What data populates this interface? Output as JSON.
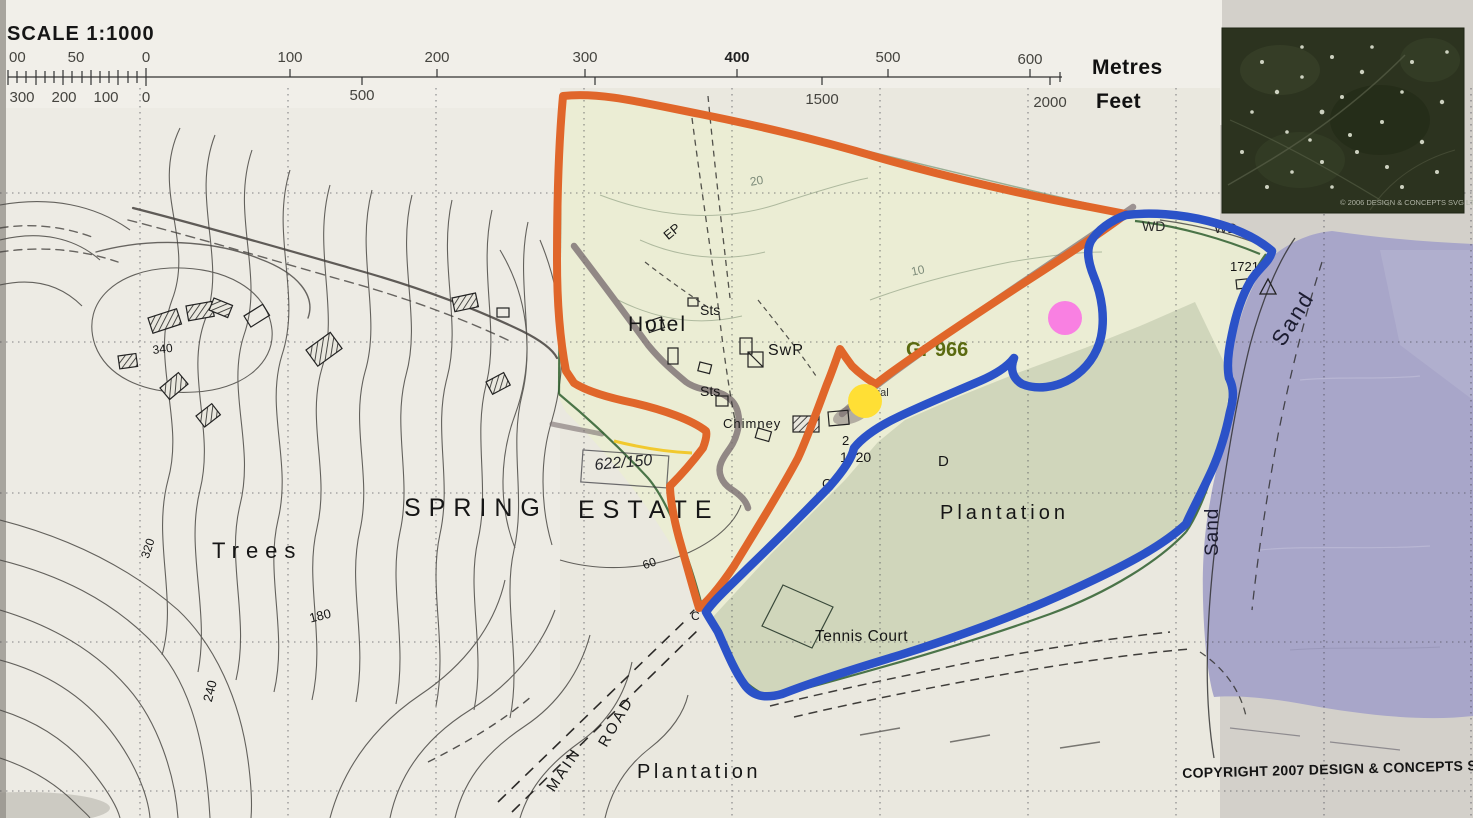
{
  "colors": {
    "orange-route": "#e0662a",
    "blue-route": "#2b52c8",
    "yellow-marker": "#ffdf35",
    "pink-marker": "#f980e2",
    "sea-lavender": "#a8a6c9",
    "estate-fill": "#eaedd2",
    "plantation-fill": "#cbd1b6",
    "road-gray": "#7a6e70",
    "boundary-green": "#2f5f2f",
    "grid-ink": "#3c3c44",
    "contour-ink": "#4b4945",
    "gr-text": "#5a6a10"
  },
  "scale": {
    "title": "SCALE 1:1000",
    "metres_unit": "Metres",
    "feet_unit": "Feet",
    "metres_ticks": [
      "00",
      "50",
      "0",
      "100",
      "200",
      "300",
      "400",
      "500",
      "600"
    ],
    "feet_ticks": [
      "300",
      "200",
      "100",
      "0",
      "500",
      "1500",
      "2000"
    ]
  },
  "labels": {
    "hotel": "Hotel",
    "sts_upper": "Sts",
    "swp": "SwP",
    "sts_lower": "Sts",
    "chimney": "Chimney",
    "ep": "EP",
    "trees": "Trees",
    "spring": "SPRING",
    "estate": "ESTATE",
    "plantation_mid": "Plantation",
    "plantation_bottom": "Plantation",
    "tennis": "Tennis Court",
    "main": "MAIN",
    "road": "ROAD",
    "sand_upper": "Sand",
    "sand_lower": "Sand",
    "wd_left": "WD",
    "wd_right": "WD"
  },
  "contours": {
    "c340": "340",
    "c320": "320",
    "c240": "240",
    "c180": "180",
    "c60": "60",
    "c20": "20",
    "c10": "10"
  },
  "spots": {
    "n1721": "1721",
    "n1720": "1720",
    "n2": "2",
    "c_upper": "C",
    "c_lower": "C",
    "d": "D",
    "gal": "gal"
  },
  "annotations": {
    "gr_ref": "Gr 966",
    "handwritten": "622/150"
  },
  "credits": {
    "map_copyright": "COPYRIGHT 2007 DESIGN & CONCEPTS SVG LTD.",
    "inset_credit": "© 2006 DESIGN & CONCEPTS SVG LTD"
  }
}
